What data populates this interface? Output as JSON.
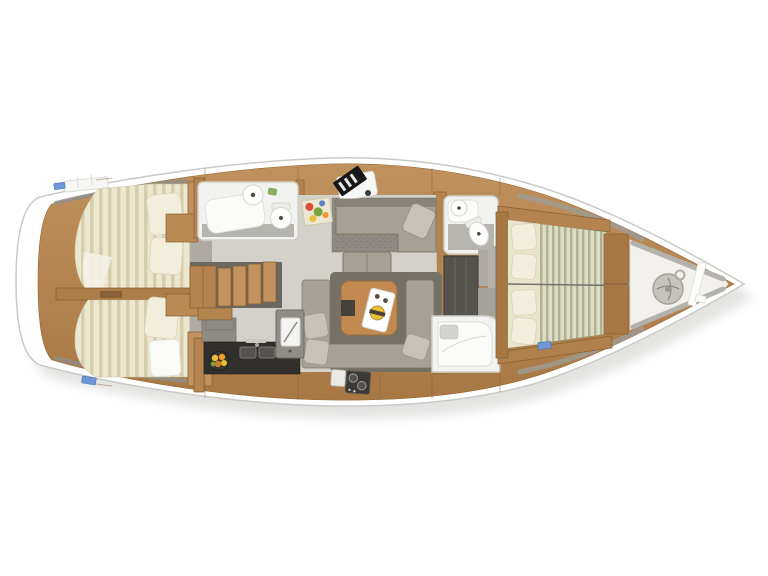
{
  "document": {
    "title": "Sailing yacht interior deck plan (top view)",
    "type": "yacht-floorplan",
    "orientation": {
      "bow": "right",
      "stern": "left"
    }
  },
  "hull": {
    "fill": "#ffffff",
    "outline": "#c9c9c6",
    "shadow": "#dfdfdd"
  },
  "palette": {
    "wood": "#b5834f",
    "wood_dark": "#a87844",
    "wood_light": "#c2925f",
    "floor": "#d4d1ca",
    "floor_dark": "#aeaaa3",
    "carpet": "#8f8b84",
    "mattress": "#ece7cf",
    "mattress_stripe": "#d5cdab",
    "mattress_fwd": "#deddc2",
    "mattress_fwd_stripe": "#adb294",
    "pillow": "#f2eedb",
    "sofa": "#a6a095",
    "sofa_dark": "#767167",
    "sofa_pillow": "#c6c2ba",
    "bathroom": "#f2f2f0",
    "fixture_white": "#fdfdfb",
    "counter_dark": "#302f2c",
    "steel_gray": "#908c86",
    "wardrobe_dark": "#56534e",
    "hatch_blue": "#6f97d6",
    "table_wood": "#c28a50",
    "accent_yellow": "#e8c03a",
    "accent_orange": "#ef9a2c",
    "accent_red": "#d94f35",
    "accent_green": "#7aa23f"
  },
  "rooms": [
    {
      "id": "aft-cabin-upper",
      "name": "Aft double cabin (starboard)",
      "features": "double berth with striped mattress, two pillows, wardrobe"
    },
    {
      "id": "aft-cabin-lower",
      "name": "Aft double cabin (port)",
      "features": "double berth with striped mattress, pillow, white pillow, wardrobe"
    },
    {
      "id": "aft-head",
      "name": "Aft bathroom",
      "features": "shower, washbasin, toilet"
    },
    {
      "id": "companionway",
      "name": "Companionway stairs",
      "features": "wooden steps down into salon"
    },
    {
      "id": "galley",
      "name": "Galley",
      "features": "dark counter, double sink, refrigerator, two-burner stove, fruit bowl"
    },
    {
      "id": "salon",
      "name": "Salon",
      "features": "U-shaped sofa, wooden dining table with menu card, ottoman, lounge sofa with cushion, dark rug"
    },
    {
      "id": "nav-station",
      "name": "Navigation station",
      "features": "chart desk with dark instrument panel"
    },
    {
      "id": "fwd-head-upper",
      "name": "Forward bathroom (starboard)",
      "features": "washbasin, toilet, shower tray"
    },
    {
      "id": "wardrobe",
      "name": "Wardrobe lockers",
      "features": "dark panelled lockers between forward bathrooms"
    },
    {
      "id": "fwd-head-lower",
      "name": "Forward bathroom (port)",
      "features": "bathtub / shower with seat"
    },
    {
      "id": "forward-cabin",
      "name": "Forward owner cabin",
      "features": "large double berth, four pillows, centreline split, side lockers"
    },
    {
      "id": "anchor-locker",
      "name": "Bow anchor locker",
      "features": "anchor windlass with rode ring, white divider"
    }
  ],
  "decor": [
    {
      "id": "floral-painting",
      "name": "floral artwork"
    },
    {
      "id": "menu-card",
      "name": "white card with plate on salon table"
    },
    {
      "id": "deck-hatches",
      "name": "blue deck hatches"
    },
    {
      "id": "stern-shelf",
      "name": "white stern shelf"
    }
  ]
}
